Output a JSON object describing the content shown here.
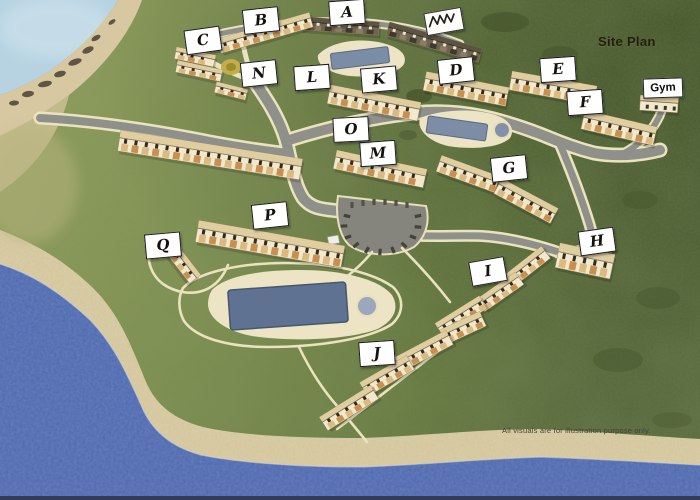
{
  "page": {
    "title": "Site Plan",
    "disclaimer": "All visuals are for illustration purpose only."
  },
  "gym": {
    "label": "Gym"
  },
  "site_labels": [
    {
      "id": "a",
      "text": "A"
    },
    {
      "id": "b",
      "text": "B"
    },
    {
      "id": "c",
      "text": "C"
    },
    {
      "id": "d",
      "text": "D"
    },
    {
      "id": "e",
      "text": "E"
    },
    {
      "id": "f",
      "text": "F"
    },
    {
      "id": "g",
      "text": "G"
    },
    {
      "id": "h",
      "text": "H"
    },
    {
      "id": "i",
      "text": "I"
    },
    {
      "id": "j",
      "text": "J"
    },
    {
      "id": "k",
      "text": "K"
    },
    {
      "id": "l",
      "text": "L"
    },
    {
      "id": "m",
      "text": "M"
    },
    {
      "id": "n",
      "text": "N"
    },
    {
      "id": "o",
      "text": "O"
    },
    {
      "id": "p",
      "text": "P"
    },
    {
      "id": "q",
      "text": "Q"
    }
  ],
  "annotations": {
    "handwritten_mark": "illegible scribble"
  },
  "features": {
    "pools": [
      "upper-pool",
      "east-pool",
      "main-pool"
    ],
    "parking": "central-parking-lot",
    "water": [
      "sea-lagoon",
      "coast-sea"
    ],
    "terrain": [
      "cliff",
      "beach",
      "grass-hill"
    ]
  },
  "colors": {
    "sea": "#4d68ae",
    "sky": "#b7d3e2",
    "sand": "#dccfa6",
    "cliff": "#d7c8a2",
    "grass_light": "#95a35e",
    "grass_dark": "#57693a",
    "road": "#90908a",
    "path_cream": "#eae3bd",
    "pool_water": "#5f7292",
    "pool_deck": "#ece4c4",
    "building_wall": "#f2e9cd",
    "building_roof": "#e0cda0",
    "building_window": "#2f2b24",
    "building_balcony": "#c98f4f",
    "label_bg": "#ffffff",
    "label_border": "#1a1a1a",
    "title_text": "#241c12",
    "disclaimer_text": "#42403a"
  }
}
